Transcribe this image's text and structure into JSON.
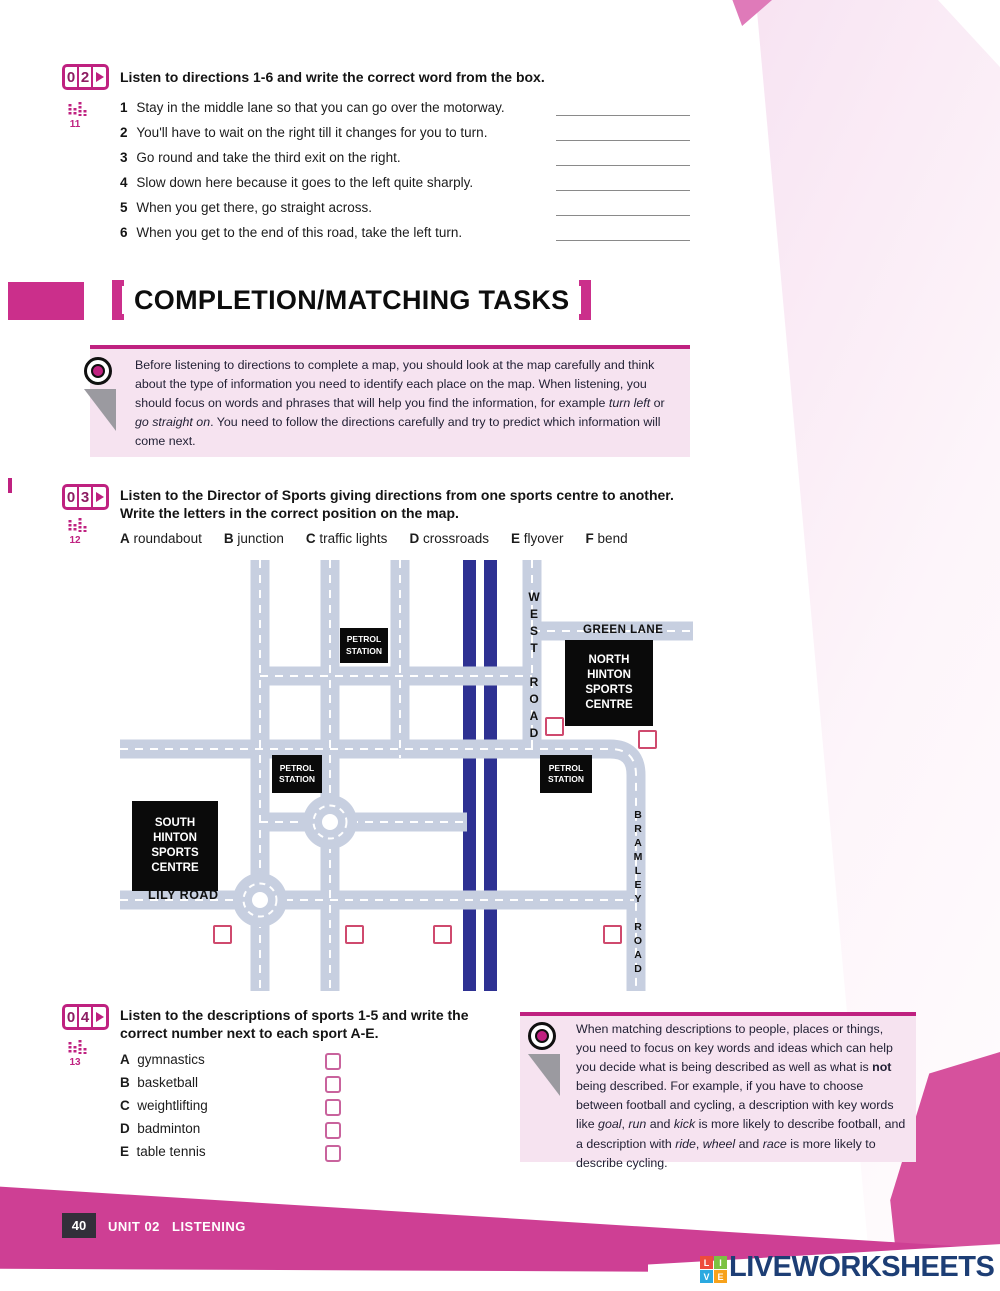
{
  "colors": {
    "accent_magenta": "#bf2180",
    "heading_pink": "#cb2f8b",
    "footer_pink": "#ce3f94",
    "road_gray": "#c7cfe0",
    "motorway_blue": "#2e3192",
    "tip_background": "#f6e3f0",
    "logo_navy": "#1d3e75",
    "answer_box_red": "#cf4a6e"
  },
  "exercise02": {
    "num_digits": [
      "0",
      "2"
    ],
    "track": "11",
    "instruction": "Listen to directions 1-6 and write the correct word from the box.",
    "items": [
      {
        "num": "1",
        "text": "Stay in the middle lane so that you can go over the motorway."
      },
      {
        "num": "2",
        "text": "You'll have to wait on the right till it changes for you to turn."
      },
      {
        "num": "3",
        "text": "Go round and take the third exit on the right."
      },
      {
        "num": "4",
        "text": "Slow down here because it goes to the left quite sharply."
      },
      {
        "num": "5",
        "text": "When you get there, go straight across."
      },
      {
        "num": "6",
        "text": "When you get to the end of this road, take the left turn."
      }
    ]
  },
  "section_heading": {
    "title": "COMPLETION/MATCHING TASKS"
  },
  "tip1": {
    "segments": [
      {
        "t": "Before listening to directions to complete a map, you should look at the map carefully and think about the type of information you need to identify each place on the map. When listening, you should focus on words and phrases that will help you find the information, for example "
      },
      {
        "t": "turn left",
        "i": true
      },
      {
        "t": " or "
      },
      {
        "t": "go straight on",
        "i": true
      },
      {
        "t": ". You need to follow the directions carefully and try to predict which information will come next."
      }
    ]
  },
  "exercise03": {
    "num_digits": [
      "0",
      "3"
    ],
    "track": "12",
    "instruction_line1": "Listen to the Director of Sports giving directions from one sports centre to another.",
    "instruction_line2": "Write the letters in the correct position on the map.",
    "options": [
      {
        "letter": "A",
        "label": "roundabout"
      },
      {
        "letter": "B",
        "label": "junction"
      },
      {
        "letter": "C",
        "label": "traffic lights"
      },
      {
        "letter": "D",
        "label": "crossroads"
      },
      {
        "letter": "E",
        "label": "flyover"
      },
      {
        "letter": "F",
        "label": "bend"
      }
    ]
  },
  "map": {
    "road_labels": {
      "green_lane": "GREEN LANE",
      "west_road": "WEST ROAD",
      "bramley_road": "BRAMLEY ROAD",
      "lily_road": "LILY ROAD"
    },
    "places": {
      "petrol1": "PETROL STATION",
      "petrol2": "PETROL STATION",
      "petrol3": "PETROL STATION",
      "north_centre": "NORTH HINTON SPORTS CENTRE",
      "south_centre": "SOUTH HINTON SPORTS CENTRE"
    }
  },
  "exercise04": {
    "num_digits": [
      "0",
      "4"
    ],
    "track": "13",
    "instruction_line1": "Listen to the descriptions of sports 1-5 and write the",
    "instruction_line2": "correct number next to each sport A-E.",
    "sports": [
      {
        "letter": "A",
        "label": "gymnastics"
      },
      {
        "letter": "B",
        "label": "basketball"
      },
      {
        "letter": "C",
        "label": "weightlifting"
      },
      {
        "letter": "D",
        "label": "badminton"
      },
      {
        "letter": "E",
        "label": "table tennis"
      }
    ]
  },
  "tip2": {
    "segments": [
      {
        "t": "When matching descriptions to people, places or things, you need to focus on key words and ideas which can help you decide what is being described as well as what is "
      },
      {
        "t": "not",
        "b": true
      },
      {
        "t": " being described. For example, if you have to choose between football and cycling, a description with key words like "
      },
      {
        "t": "goal",
        "i": true
      },
      {
        "t": ", "
      },
      {
        "t": "run",
        "i": true
      },
      {
        "t": " and "
      },
      {
        "t": "kick",
        "i": true
      },
      {
        "t": " is more likely to describe football, and a description with "
      },
      {
        "t": "ride",
        "i": true
      },
      {
        "t": ", "
      },
      {
        "t": "wheel",
        "i": true
      },
      {
        "t": " and "
      },
      {
        "t": "race",
        "i": true
      },
      {
        "t": " is more likely to describe cycling."
      }
    ]
  },
  "footer": {
    "page_number": "40",
    "unit": "UNIT 02",
    "section": "LISTENING"
  },
  "logo": {
    "tiles": [
      "L",
      "I",
      "V",
      "E"
    ],
    "text": "LIVEWORKSHEETS"
  }
}
